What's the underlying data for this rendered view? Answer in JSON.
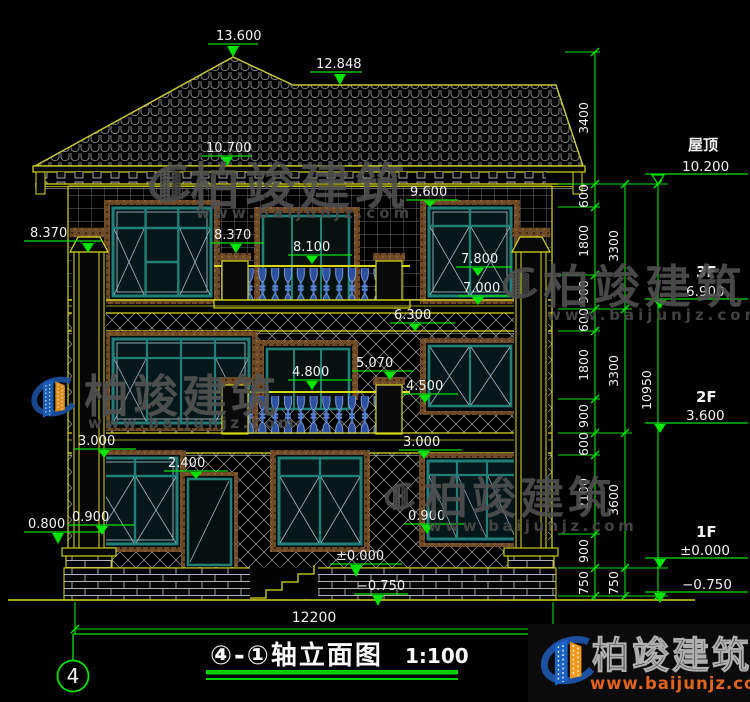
{
  "marks": {
    "peak": "13.600",
    "ridge": "12.848",
    "eave": "10.700",
    "left_capital": "8.370",
    "f3_win_head": "9.600",
    "f3_pier": "8.370",
    "f3_door_head": "8.100",
    "f3_right_head": "7.800",
    "f3_band": "7.000",
    "f3_floor": "6.300",
    "f2_pier": "5.070",
    "f2_door_head": "4.800",
    "f2_right_sill": "4.500",
    "f1_left_head": "3.000",
    "f1_door_head": "2.400",
    "f1_right_head": "3.000",
    "f1_left_sill": "0.900",
    "pedestal": "0.800",
    "f1_right_sill": "0.900",
    "ground": "±0.000",
    "foundation": "−0.750"
  },
  "right": {
    "roof_label": "屋顶",
    "roof_value": "10.200",
    "f3_label": "3F",
    "f3_value": "6.900",
    "f2_label": "2F",
    "f2_value": "3.600",
    "f1_label": "1F",
    "f1_value": "±0.000",
    "foundation_value": "−0.750",
    "chain_inner": [
      "3400",
      "600",
      "1800",
      "900",
      "600",
      "1800",
      "900",
      "600",
      "2100",
      "900",
      "750"
    ],
    "chain_mid": [
      "3300",
      "3300",
      "3600",
      "750"
    ],
    "chain_outer": [
      "10950"
    ]
  },
  "bottom": {
    "total_width": "12200",
    "axis_bubble": "4",
    "title": "④-①轴立面图",
    "scale": "1:100"
  },
  "watermark": {
    "name": "柏竣建筑",
    "url": "www.baijunjz.com"
  },
  "brand": {
    "name": "柏竣建筑",
    "url": "www.baijunjz.com"
  }
}
